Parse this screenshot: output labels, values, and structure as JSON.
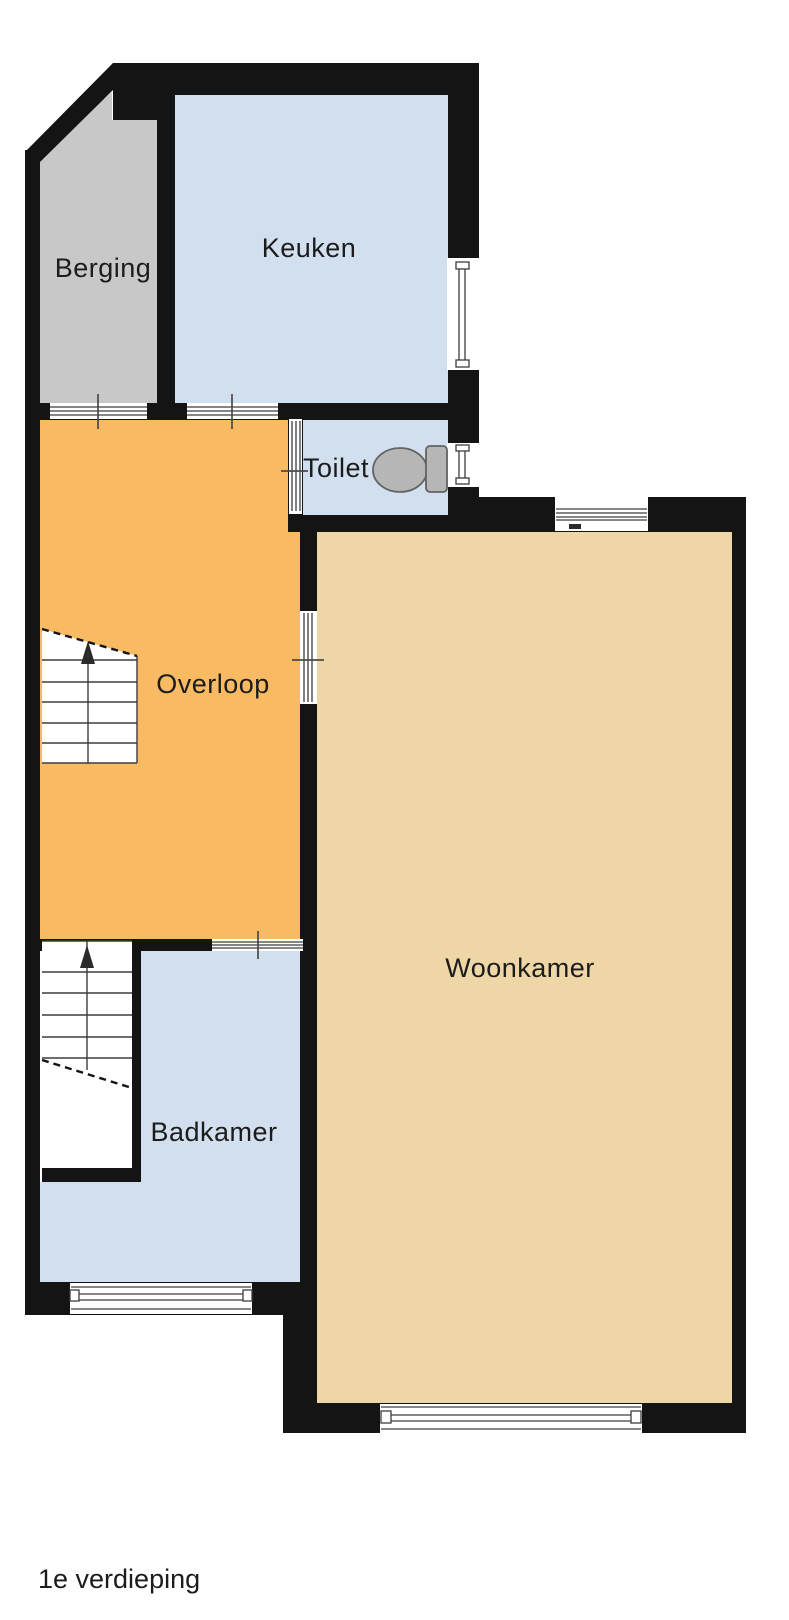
{
  "floorplan": {
    "floor_label": "1e verdieping",
    "rooms": [
      {
        "id": "berging",
        "label": "Berging",
        "fill": "#c8c8c8"
      },
      {
        "id": "keuken",
        "label": "Keuken",
        "fill": "#d2dfee"
      },
      {
        "id": "toilet",
        "label": "Toilet",
        "fill": "#d2dfee"
      },
      {
        "id": "overloop",
        "label": "Overloop",
        "fill": "#f8bb63"
      },
      {
        "id": "woonkamer",
        "label": "Woonkamer",
        "fill": "#eed6a6"
      },
      {
        "id": "badkamer",
        "label": "Badkamer",
        "fill": "#d2dfee"
      }
    ],
    "colors": {
      "background": "#ffffff",
      "wall": "#141414",
      "opening": "#ffffff",
      "detail_line": "#3d3d3d",
      "tick": "#4a4a4a",
      "stair_line": "#3d3d3d",
      "arrow": "#2a2a2a",
      "fixture_fill": "#b6b6b6",
      "fixture_stroke": "#636363",
      "label_text": "#1c1c1c"
    },
    "stairs": [
      {
        "id": "staircase-overloop",
        "direction": "up"
      },
      {
        "id": "staircase-badkamer",
        "direction": "up"
      }
    ],
    "fixtures": [
      {
        "id": "toilet-fixture",
        "type": "toilet"
      }
    ]
  }
}
